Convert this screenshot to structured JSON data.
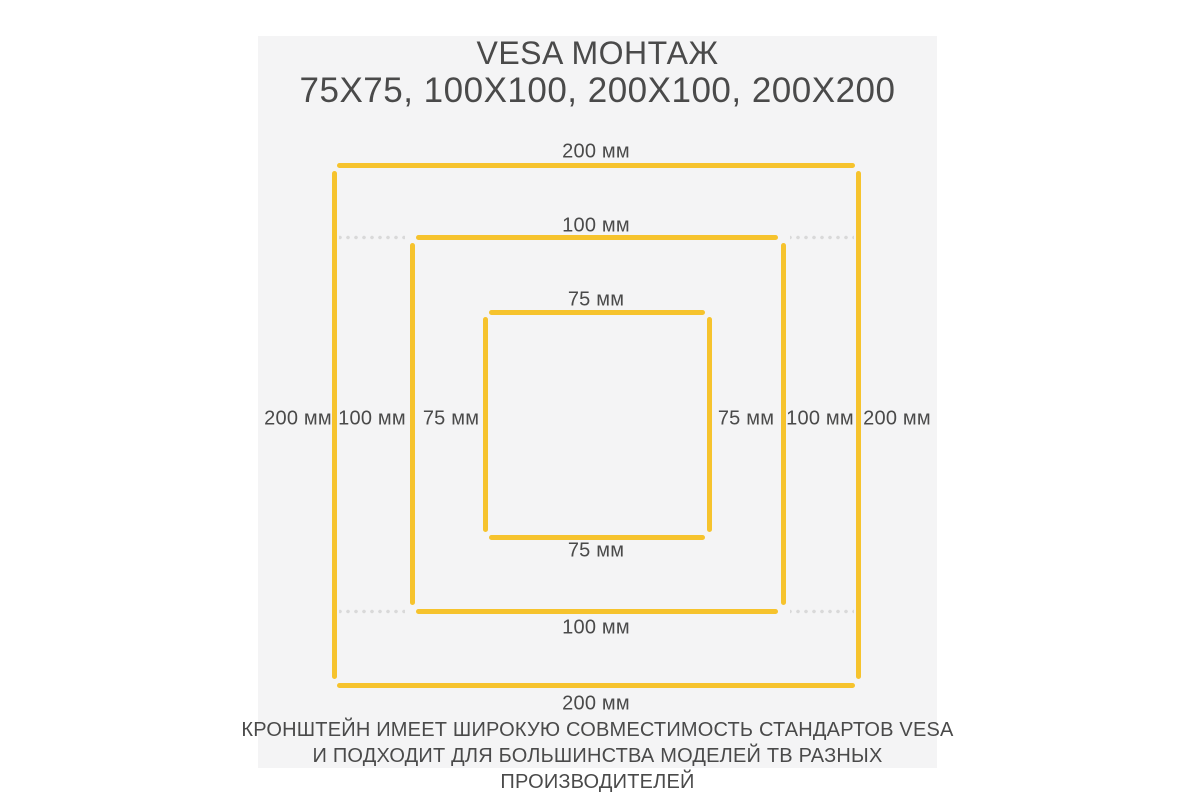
{
  "theme": {
    "page-bg": "#ffffff",
    "panel-bg": "#f4f4f5",
    "accent": "#f6c32d",
    "dot": "#d9d9d9",
    "text": "#4a4a4a"
  },
  "title": {
    "line1": "VESA МОНТАЖ",
    "line2": "75Х75, 100Х100, 200Х100, 200Х200"
  },
  "diagram": {
    "type": "vesa-mount-dimension-diagram",
    "squares": [
      {
        "id": "vesa-200",
        "width_mm": 200,
        "height_mm": 200,
        "label": "200 мм"
      },
      {
        "id": "vesa-100",
        "width_mm": 100,
        "height_mm": 100,
        "label": "100 мм"
      },
      {
        "id": "vesa-75",
        "width_mm": 75,
        "height_mm": 75,
        "label": "75 мм"
      }
    ],
    "labels": {
      "top_200": "200 мм",
      "top_100": "100 мм",
      "top_75": "75 мм",
      "left_200": "200 мм",
      "left_100": "100 мм",
      "left_75": "75 мм",
      "right_75": "75 мм",
      "right_100": "100 мм",
      "right_200": "200 мм",
      "bottom_75": "75 мм",
      "bottom_100": "100 мм",
      "bottom_200": "200 мм"
    }
  },
  "footer": {
    "line1": "КРОНШТЕЙН ИМЕЕТ ШИРОКУЮ СОВМЕСТИМОСТЬ СТАНДАРТОВ VESA",
    "line2": "И ПОДХОДИТ ДЛЯ БОЛЬШИНСТВА МОДЕЛЕЙ ТВ РАЗНЫХ ПРОИЗВОДИТЕЛЕЙ"
  }
}
